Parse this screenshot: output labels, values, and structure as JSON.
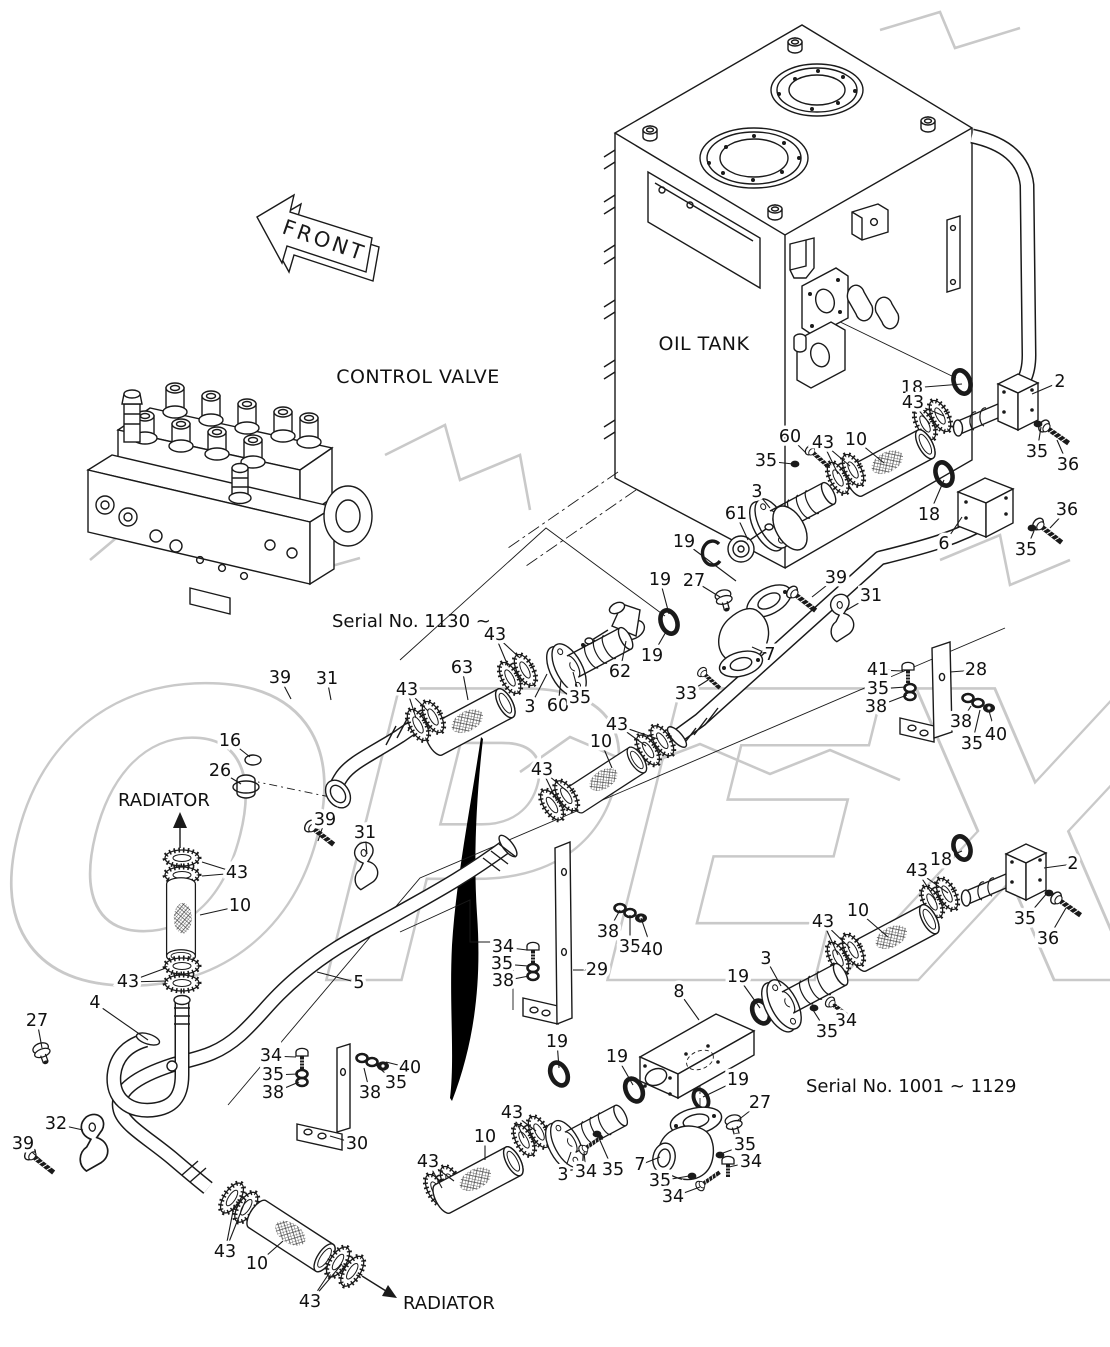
{
  "labels": {
    "front": "FRONT",
    "control_valve": "CONTROL VALVE",
    "oil_tank": "OIL TANK",
    "radiator_left": "RADIATOR",
    "radiator_bottom": "RADIATOR",
    "serial_upper": "Serial No. 1130 ~",
    "serial_lower": "Serial No. 1001 ~ 1129",
    "watermark": "OPEX"
  },
  "colors": {
    "ink": "#1a1a1a",
    "watermark": "#c9c9c9",
    "swoosh": "#000000",
    "background": "#ffffff"
  },
  "callouts": [
    {
      "n": "18",
      "x": 912,
      "y": 388,
      "t": [
        [
          962,
          384
        ]
      ]
    },
    {
      "n": "2",
      "x": 1060,
      "y": 382,
      "t": [
        [
          1032,
          394
        ]
      ]
    },
    {
      "n": "43",
      "x": 913,
      "y": 403,
      "t": [
        [
          930,
          424
        ],
        [
          944,
          416
        ]
      ]
    },
    {
      "n": "10",
      "x": 856,
      "y": 440,
      "t": [
        [
          884,
          463
        ]
      ]
    },
    {
      "n": "60",
      "x": 790,
      "y": 437,
      "t": [
        [
          806,
          453
        ]
      ]
    },
    {
      "n": "35",
      "x": 766,
      "y": 461,
      "t": [
        [
          793,
          464
        ]
      ]
    },
    {
      "n": "43",
      "x": 823,
      "y": 443,
      "t": [
        [
          838,
          474
        ],
        [
          850,
          466
        ]
      ]
    },
    {
      "n": "3",
      "x": 757,
      "y": 492,
      "t": [
        [
          770,
          508
        ]
      ]
    },
    {
      "n": "61",
      "x": 736,
      "y": 514,
      "t": [
        [
          748,
          540
        ]
      ]
    },
    {
      "n": "19",
      "x": 684,
      "y": 542,
      "t": [
        [
          736,
          581
        ]
      ]
    },
    {
      "n": "18",
      "x": 929,
      "y": 515,
      "t": [
        [
          944,
          480
        ]
      ]
    },
    {
      "n": "6",
      "x": 944,
      "y": 544,
      "t": [
        [
          962,
          517
        ]
      ]
    },
    {
      "n": "35",
      "x": 1037,
      "y": 452,
      "t": [
        [
          1041,
          427
        ]
      ]
    },
    {
      "n": "36",
      "x": 1068,
      "y": 465,
      "t": [
        [
          1057,
          440
        ]
      ]
    },
    {
      "n": "36",
      "x": 1067,
      "y": 510,
      "t": [
        [
          1050,
          528
        ]
      ]
    },
    {
      "n": "35",
      "x": 1026,
      "y": 550,
      "t": [
        [
          1034,
          531
        ]
      ]
    },
    {
      "n": "19",
      "x": 660,
      "y": 580,
      "t": [
        [
          669,
          614
        ]
      ]
    },
    {
      "n": "27",
      "x": 694,
      "y": 581,
      "t": [
        [
          720,
          597
        ]
      ]
    },
    {
      "n": "39",
      "x": 836,
      "y": 578,
      "t": [
        [
          812,
          597
        ]
      ]
    },
    {
      "n": "31",
      "x": 871,
      "y": 596,
      "t": [
        [
          845,
          611
        ]
      ]
    },
    {
      "n": "19",
      "x": 652,
      "y": 656,
      "t": [
        [
          667,
          630
        ]
      ]
    },
    {
      "n": "62",
      "x": 620,
      "y": 672,
      "t": [
        [
          626,
          641
        ]
      ]
    },
    {
      "n": "33",
      "x": 686,
      "y": 694,
      "t": [
        [
          708,
          680
        ]
      ]
    },
    {
      "n": "7",
      "x": 770,
      "y": 655,
      "t": [
        [
          752,
          647
        ]
      ]
    },
    {
      "n": "41",
      "x": 878,
      "y": 670,
      "t": [
        [
          903,
          671
        ]
      ]
    },
    {
      "n": "35",
      "x": 878,
      "y": 689,
      "t": [
        [
          906,
          687
        ]
      ]
    },
    {
      "n": "38",
      "x": 876,
      "y": 707,
      "t": [
        [
          907,
          695
        ]
      ]
    },
    {
      "n": "28",
      "x": 976,
      "y": 670,
      "t": [
        [
          950,
          672
        ]
      ]
    },
    {
      "n": "38",
      "x": 961,
      "y": 722,
      "t": [
        [
          971,
          706
        ]
      ]
    },
    {
      "n": "35",
      "x": 972,
      "y": 744,
      "t": [
        [
          980,
          710
        ]
      ]
    },
    {
      "n": "40",
      "x": 996,
      "y": 735,
      "t": [
        [
          989,
          711
        ]
      ]
    },
    {
      "n": "43",
      "x": 495,
      "y": 635,
      "t": [
        [
          508,
          666
        ],
        [
          520,
          658
        ]
      ]
    },
    {
      "n": "63",
      "x": 462,
      "y": 668,
      "t": [
        [
          468,
          700
        ]
      ]
    },
    {
      "n": "43",
      "x": 407,
      "y": 690,
      "t": [
        [
          416,
          718
        ],
        [
          428,
          711
        ]
      ]
    },
    {
      "n": "3",
      "x": 530,
      "y": 707,
      "t": [
        [
          547,
          674
        ]
      ]
    },
    {
      "n": "60",
      "x": 558,
      "y": 706,
      "t": [
        [
          561,
          680
        ]
      ]
    },
    {
      "n": "35",
      "x": 580,
      "y": 698,
      "t": [
        [
          573,
          672
        ]
      ]
    },
    {
      "n": "43",
      "x": 617,
      "y": 725,
      "t": [
        [
          646,
          746
        ],
        [
          658,
          739
        ]
      ]
    },
    {
      "n": "10",
      "x": 601,
      "y": 742,
      "t": [
        [
          612,
          768
        ]
      ]
    },
    {
      "n": "43",
      "x": 542,
      "y": 770,
      "t": [
        [
          556,
          799
        ],
        [
          568,
          792
        ]
      ]
    },
    {
      "n": "39",
      "x": 280,
      "y": 678,
      "t": [
        [
          291,
          699
        ]
      ]
    },
    {
      "n": "31",
      "x": 327,
      "y": 679,
      "t": [
        [
          331,
          700
        ]
      ]
    },
    {
      "n": "16",
      "x": 230,
      "y": 741,
      "t": [
        [
          250,
          757
        ]
      ]
    },
    {
      "n": "26",
      "x": 220,
      "y": 771,
      "t": [
        [
          241,
          784
        ]
      ]
    },
    {
      "n": "43",
      "x": 237,
      "y": 873,
      "t": [
        [
          202,
          862
        ],
        [
          202,
          876
        ]
      ]
    },
    {
      "n": "10",
      "x": 240,
      "y": 906,
      "t": [
        [
          200,
          915
        ]
      ]
    },
    {
      "n": "39",
      "x": 325,
      "y": 820,
      "t": [
        [
          318,
          841
        ]
      ]
    },
    {
      "n": "31",
      "x": 365,
      "y": 833,
      "t": [
        [
          367,
          854
        ]
      ]
    },
    {
      "n": "43",
      "x": 128,
      "y": 982,
      "t": [
        [
          166,
          968
        ],
        [
          166,
          981
        ]
      ]
    },
    {
      "n": "5",
      "x": 359,
      "y": 983,
      "t": [
        [
          317,
          972
        ]
      ]
    },
    {
      "n": "4",
      "x": 95,
      "y": 1003,
      "t": [
        [
          148,
          1040
        ]
      ]
    },
    {
      "n": "27",
      "x": 37,
      "y": 1021,
      "t": [
        [
          42,
          1048
        ]
      ]
    },
    {
      "n": "34",
      "x": 271,
      "y": 1056,
      "t": [
        [
          296,
          1057
        ]
      ]
    },
    {
      "n": "35",
      "x": 273,
      "y": 1075,
      "t": [
        [
          298,
          1074
        ]
      ]
    },
    {
      "n": "38",
      "x": 273,
      "y": 1093,
      "t": [
        [
          299,
          1082
        ]
      ]
    },
    {
      "n": "40",
      "x": 410,
      "y": 1068,
      "t": [
        [
          386,
          1062
        ]
      ]
    },
    {
      "n": "35",
      "x": 396,
      "y": 1083,
      "t": [
        [
          376,
          1065
        ]
      ]
    },
    {
      "n": "38",
      "x": 370,
      "y": 1093,
      "t": [
        [
          364,
          1068
        ]
      ]
    },
    {
      "n": "32",
      "x": 56,
      "y": 1124,
      "t": [
        [
          83,
          1130
        ]
      ]
    },
    {
      "n": "39",
      "x": 23,
      "y": 1144,
      "t": [
        [
          42,
          1161
        ]
      ]
    },
    {
      "n": "30",
      "x": 357,
      "y": 1144,
      "t": [
        [
          330,
          1136
        ]
      ]
    },
    {
      "n": "34",
      "x": 503,
      "y": 947,
      "t": [
        [
          527,
          950
        ]
      ]
    },
    {
      "n": "35",
      "x": 502,
      "y": 964,
      "t": [
        [
          528,
          966
        ]
      ]
    },
    {
      "n": "38",
      "x": 503,
      "y": 981,
      "t": [
        [
          529,
          976
        ]
      ]
    },
    {
      "n": "29",
      "x": 597,
      "y": 970,
      "t": [
        [
          573,
          970
        ]
      ]
    },
    {
      "n": "38",
      "x": 608,
      "y": 932,
      "t": [
        [
          620,
          910
        ]
      ]
    },
    {
      "n": "35",
      "x": 630,
      "y": 947,
      "t": [
        [
          630,
          915
        ]
      ]
    },
    {
      "n": "40",
      "x": 652,
      "y": 950,
      "t": [
        [
          641,
          918
        ]
      ]
    },
    {
      "n": "19",
      "x": 557,
      "y": 1042,
      "t": [
        [
          559,
          1068
        ]
      ]
    },
    {
      "n": "19",
      "x": 617,
      "y": 1057,
      "t": [
        [
          633,
          1085
        ]
      ]
    },
    {
      "n": "8",
      "x": 679,
      "y": 992,
      "t": [
        [
          699,
          1020
        ]
      ]
    },
    {
      "n": "19",
      "x": 738,
      "y": 977,
      "t": [
        [
          760,
          1008
        ]
      ]
    },
    {
      "n": "3",
      "x": 766,
      "y": 959,
      "t": [
        [
          781,
          986
        ]
      ]
    },
    {
      "n": "19",
      "x": 738,
      "y": 1080,
      "t": [
        [
          703,
          1097
        ]
      ]
    },
    {
      "n": "27",
      "x": 760,
      "y": 1103,
      "t": [
        [
          737,
          1121
        ]
      ]
    },
    {
      "n": "43",
      "x": 512,
      "y": 1113,
      "t": [
        [
          524,
          1138
        ],
        [
          536,
          1131
        ]
      ]
    },
    {
      "n": "10",
      "x": 485,
      "y": 1137,
      "t": [
        [
          485,
          1160
        ]
      ]
    },
    {
      "n": "43",
      "x": 428,
      "y": 1162,
      "t": [
        [
          442,
          1188
        ],
        [
          454,
          1181
        ]
      ]
    },
    {
      "n": "3",
      "x": 563,
      "y": 1175,
      "t": [
        [
          571,
          1152
        ]
      ]
    },
    {
      "n": "34",
      "x": 586,
      "y": 1172,
      "t": [
        [
          584,
          1152
        ]
      ]
    },
    {
      "n": "35",
      "x": 613,
      "y": 1170,
      "t": [
        [
          598,
          1136
        ]
      ]
    },
    {
      "n": "7",
      "x": 640,
      "y": 1165,
      "t": [
        [
          660,
          1157
        ]
      ]
    },
    {
      "n": "35",
      "x": 660,
      "y": 1181,
      "t": [
        [
          689,
          1176
        ]
      ]
    },
    {
      "n": "34",
      "x": 673,
      "y": 1197,
      "t": [
        [
          700,
          1187
        ]
      ]
    },
    {
      "n": "35",
      "x": 745,
      "y": 1145,
      "t": [
        [
          723,
          1153
        ]
      ]
    },
    {
      "n": "34",
      "x": 751,
      "y": 1162,
      "t": [
        [
          729,
          1167
        ]
      ]
    },
    {
      "n": "18",
      "x": 941,
      "y": 860,
      "t": [
        [
          962,
          851
        ]
      ]
    },
    {
      "n": "2",
      "x": 1073,
      "y": 864,
      "t": [
        [
          1044,
          868
        ]
      ]
    },
    {
      "n": "43",
      "x": 917,
      "y": 871,
      "t": [
        [
          936,
          900
        ],
        [
          948,
          893
        ]
      ]
    },
    {
      "n": "10",
      "x": 858,
      "y": 911,
      "t": [
        [
          888,
          937
        ]
      ]
    },
    {
      "n": "43",
      "x": 823,
      "y": 922,
      "t": [
        [
          838,
          955
        ],
        [
          850,
          948
        ]
      ]
    },
    {
      "n": "35",
      "x": 1025,
      "y": 919,
      "t": [
        [
          1048,
          892
        ]
      ]
    },
    {
      "n": "36",
      "x": 1048,
      "y": 939,
      "t": [
        [
          1066,
          908
        ]
      ]
    },
    {
      "n": "34",
      "x": 846,
      "y": 1021,
      "t": [
        [
          833,
          1004
        ]
      ]
    },
    {
      "n": "35",
      "x": 827,
      "y": 1032,
      "t": [
        [
          813,
          1010
        ]
      ]
    },
    {
      "n": "43",
      "x": 225,
      "y": 1252,
      "t": [
        [
          234,
          1206
        ],
        [
          246,
          1199
        ]
      ]
    },
    {
      "n": "10",
      "x": 257,
      "y": 1264,
      "t": [
        [
          283,
          1241
        ]
      ]
    },
    {
      "n": "43",
      "x": 310,
      "y": 1302,
      "t": [
        [
          330,
          1272
        ],
        [
          342,
          1264
        ]
      ]
    }
  ]
}
